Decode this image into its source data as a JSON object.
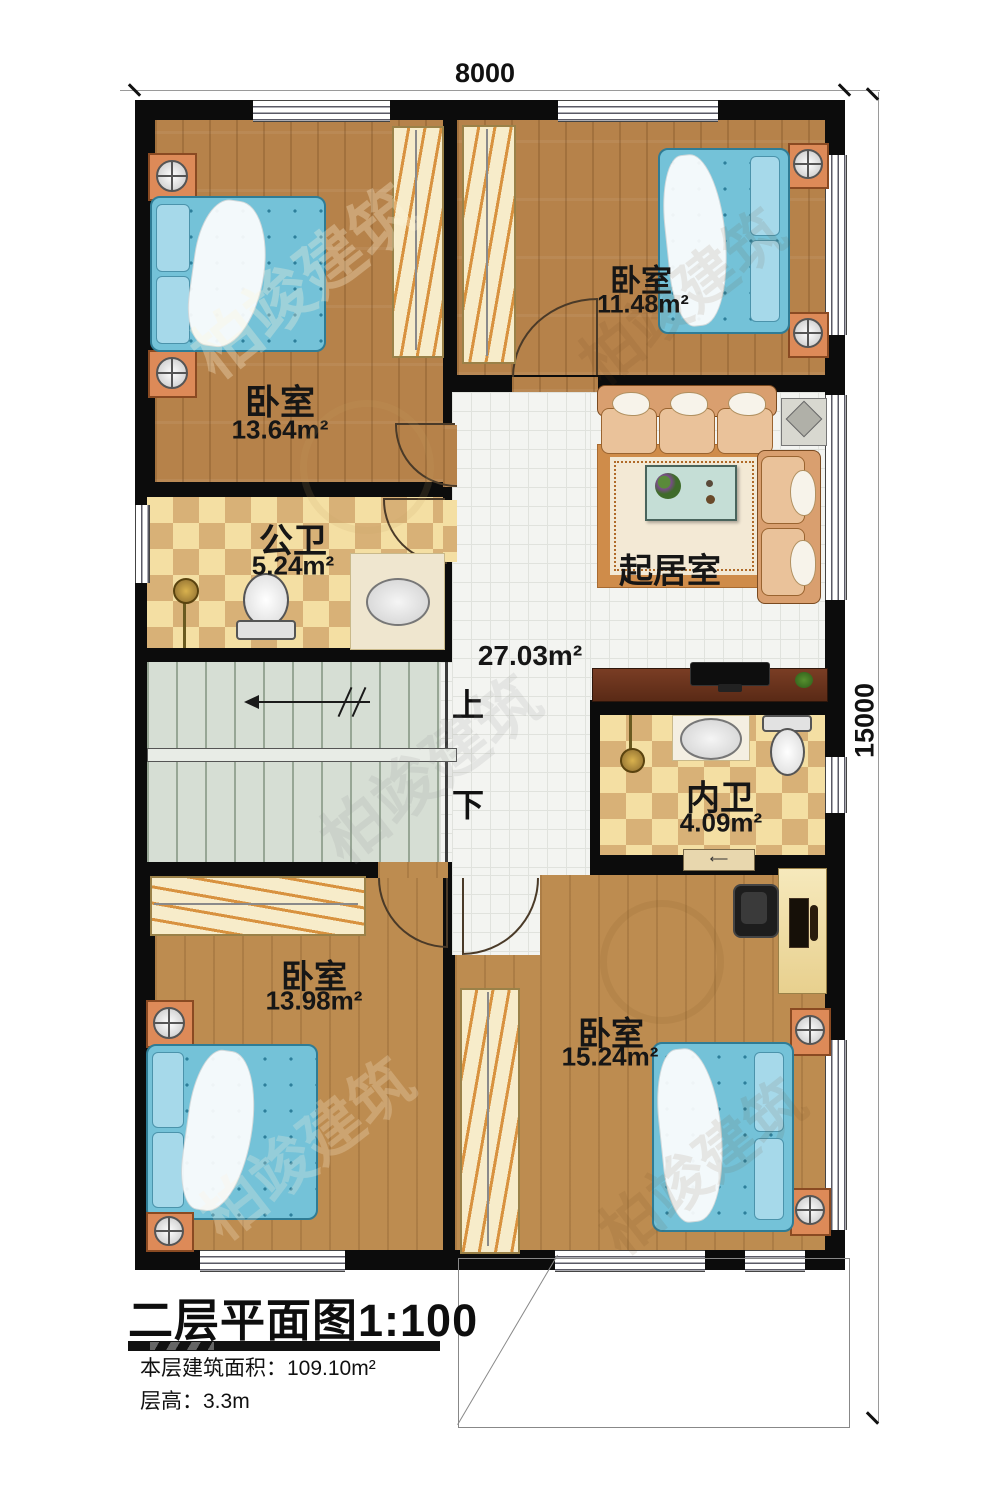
{
  "plan": {
    "title": "二层平面图1:100",
    "notes": {
      "area": "本层建筑面积：109.10m²",
      "height": "层高：3.3m"
    },
    "dimensions": {
      "top": "8000",
      "right": "15000"
    },
    "stairs": {
      "up": "上",
      "down": "下"
    },
    "rooms": {
      "bedroom_nw": {
        "name": "卧室",
        "area": "13.64m²"
      },
      "bedroom_ne": {
        "name": "卧室",
        "area": "11.48m²"
      },
      "public_bath": {
        "name": "公卫",
        "area": "5.24m²"
      },
      "living": {
        "name": "起居室",
        "area": "27.03m²"
      },
      "ensuite_bath": {
        "name": "内卫",
        "area": "4.09m²"
      },
      "bedroom_sw": {
        "name": "卧室",
        "area": "13.98m²"
      },
      "bedroom_se": {
        "name": "卧室",
        "area": "15.24m²"
      }
    },
    "watermark": "柏竣建筑",
    "colors": {
      "wall": "#0c0c0c",
      "wood": "#b6824a",
      "checker_light": "#f4dfa3",
      "checker_dark": "#d8b177",
      "tile": "#f3f4f1",
      "stair": "#d6ded4",
      "bed": "#74c2d8",
      "sofa": "#d99f6f"
    }
  }
}
